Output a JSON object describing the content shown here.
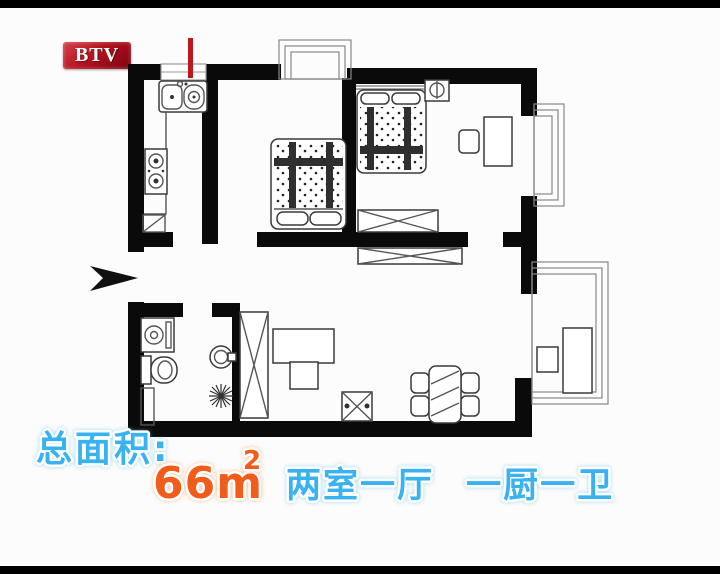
{
  "window": {
    "width": 720,
    "height": 574
  },
  "broadcaster": {
    "logo_text": "BTV"
  },
  "caption": {
    "area_label": "总面积:",
    "area_value": "66m",
    "area_exponent": "2",
    "rooms_text": "两室一厅 一厨一卫"
  },
  "colors": {
    "caption_blue": "#38b2f0",
    "caption_orange": "#f25c1a",
    "logo_red": "#b5121f",
    "wall_black": "#0a0a0a",
    "marker_red": "#c21717",
    "background": "#fcfcfc"
  },
  "floorplan": {
    "rooms": [
      "kitchen",
      "bedroom-1",
      "bedroom-2",
      "living-dining-room",
      "bathroom",
      "balcony"
    ],
    "icons": [
      "kitchen-sink-icon",
      "stove-icon",
      "double-bed-icon",
      "single-bed-icon",
      "nightstand-lamp-icon",
      "desk-icon",
      "chair-icon",
      "wardrobe-x-icon",
      "tv-cabinet-x-icon",
      "bed-bench-x-icon",
      "dining-table-icon",
      "stool-x-icon",
      "washing-machine-icon",
      "toilet-icon",
      "wash-basin-icon",
      "floor-drain-icon",
      "entrance-arrow-icon",
      "bay-window-icon",
      "balcony-railing-icon",
      "red-marker-icon"
    ]
  }
}
